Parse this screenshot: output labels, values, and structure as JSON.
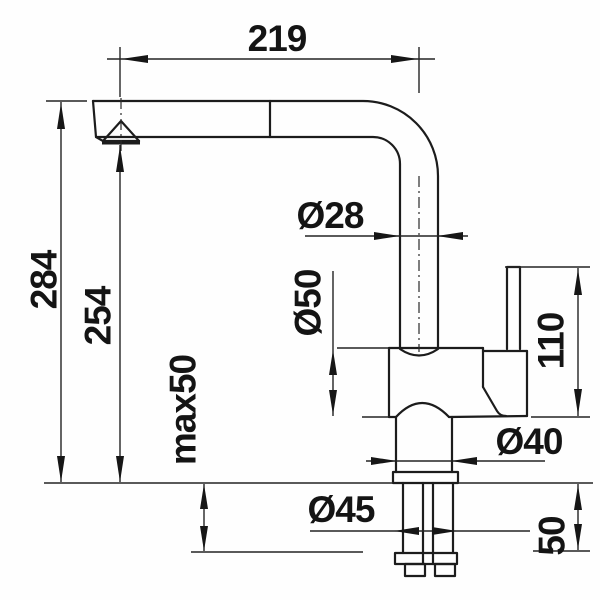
{
  "meta": {
    "type": "technical-dimension-drawing",
    "subject": "kitchen-faucet-side-view",
    "background_color": "#fefefe",
    "line_color": "#1c1c1c"
  },
  "dimensions": {
    "spout_reach": {
      "label": "219",
      "orientation": "horizontal"
    },
    "total_height": {
      "label": "284",
      "orientation": "vertical"
    },
    "spout_height": {
      "label": "254",
      "orientation": "vertical"
    },
    "max_deck_thickness": {
      "label": "max50",
      "orientation": "vertical"
    },
    "spout_tube_diameter": {
      "label": "Ø28",
      "orientation": "horizontal"
    },
    "body_diameter": {
      "label": "Ø50",
      "orientation": "vertical"
    },
    "lever_height": {
      "label": "110",
      "orientation": "vertical"
    },
    "neck_diameter": {
      "label": "Ø40",
      "orientation": "horizontal"
    },
    "shank_diameter": {
      "label": "Ø45",
      "orientation": "horizontal"
    },
    "under_counter_depth": {
      "label": "50",
      "orientation": "vertical"
    }
  }
}
